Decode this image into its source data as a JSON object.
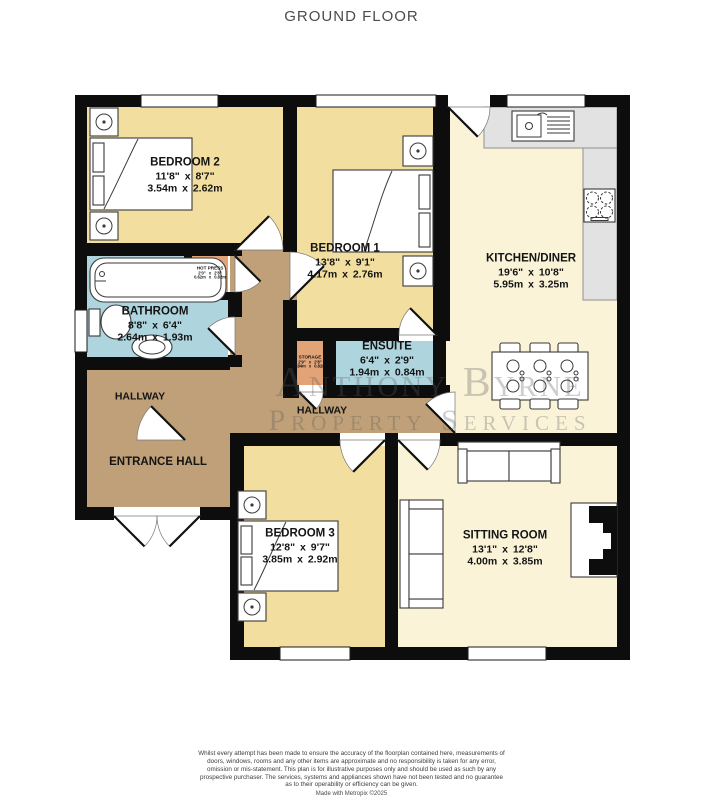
{
  "title": "GROUND FLOOR",
  "watermark": {
    "line1": "Anthony Byrne",
    "line2": "Property Services"
  },
  "rooms": {
    "bedroom2": {
      "name": "BEDROOM 2",
      "imperial": "11'8\" x 8'7\"",
      "metric": "3.54m x 2.62m"
    },
    "bedroom1": {
      "name": "BEDROOM 1",
      "imperial": "13'8\" x 9'1\"",
      "metric": "4.17m x 2.76m"
    },
    "bedroom3": {
      "name": "BEDROOM 3",
      "imperial": "12'8\" x 9'7\"",
      "metric": "3.85m x 2.92m"
    },
    "kitchen": {
      "name": "KITCHEN/DINER",
      "imperial": "19'6\" x 10'8\"",
      "metric": "5.95m x 3.25m"
    },
    "sitting": {
      "name": "SITTING ROOM",
      "imperial": "13'1\" x 12'8\"",
      "metric": "4.00m x 3.85m"
    },
    "bathroom": {
      "name": "BATHROOM",
      "imperial": "8'8\" x 6'4\"",
      "metric": "2.64m x 1.93m"
    },
    "ensuite": {
      "name": "ENSUITE",
      "imperial": "6'4\" x 2'9\"",
      "metric": "1.94m x 0.84m"
    },
    "hot_press": {
      "name": "HOT PRESS",
      "imperial": "2'0\" x 2'8\"",
      "metric": "0.62m x 0.82m"
    },
    "storage": {
      "name": "STORAGE",
      "imperial": "2'9\" x 2'8\"",
      "metric": "0.84m x 0.82m"
    },
    "hallway_west": {
      "name": "HALLWAY"
    },
    "hallway_center": {
      "name": "HALLWAY"
    },
    "entrance_hall": {
      "name": "ENTRANCE HALL"
    }
  },
  "footer": {
    "disclaimer": "Whilst every attempt has been made to ensure the accuracy of the floorplan contained here, measurements of doors, windows, rooms and any other items are approximate and no responsibility is taken for any error, omission or mis-statement. This plan is for illustrative purposes only and should be used as such by any prospective purchaser. The services, systems and appliances shown have not been tested and no guarantee as to their operability or efficiency can be given.",
    "credit": "Made with Metropix ©2025"
  },
  "colors": {
    "bedroom": "#f2dfa0",
    "living": "#faf3d8",
    "hall": "#bfa078",
    "bath": "#aed4dd",
    "closet": "#e2a377",
    "wall": "#0d0d0d",
    "counter": "#e2e2e2"
  }
}
